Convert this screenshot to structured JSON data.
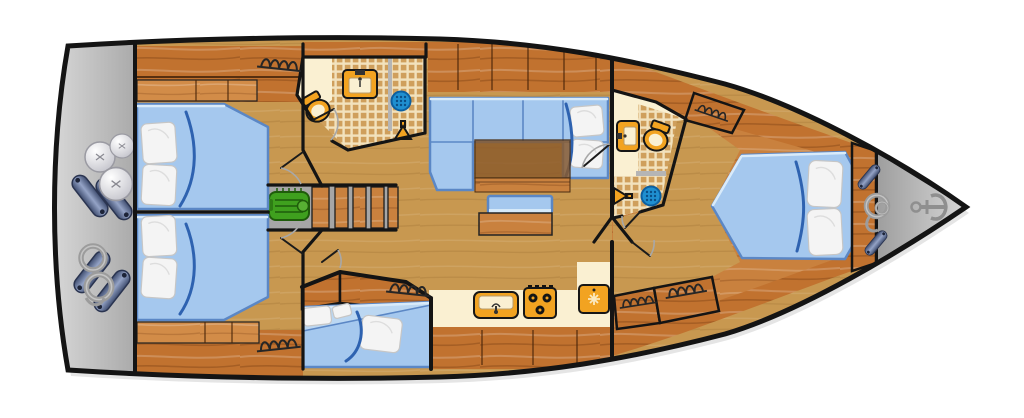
{
  "diagram": {
    "type": "sailing-yacht-interior-floor-plan",
    "description": "Top-down interior layout plan of a sailing yacht, bow pointing right, stern platform on the left"
  },
  "orientation": {
    "bow": "right",
    "stern": "left"
  },
  "colors": {
    "hull_line": "#141414",
    "floor_tan": "#C89850",
    "wood_dark": "#C1722F",
    "wood_mid": "#C9813E",
    "wood_light": "#D28C48",
    "bed_blue": "#A5C8EE",
    "bed_blue_light": "#BBD7F2",
    "bed_edge": "#5B87C5",
    "blanket_blue": "#2E62B0",
    "pillow_white": "#F4F4F4",
    "tile_base": "#F2E2BD",
    "tile_square": "#CF9F5C",
    "counter_cream": "#FAF0D2",
    "fixture_orange": "#F2A321",
    "drain_blue": "#1F8FD0",
    "engine_green": "#3FA01E",
    "platform_gray_light": "#DCDCDC",
    "platform_gray_dark": "#A9A9A9",
    "fender_dark": "#3E4C6E",
    "fender_light": "#94A3C6",
    "rope_gray": "#9C9C9C",
    "table_brown": "#8B5A2B"
  },
  "areas": [
    {
      "id": "stern-platform",
      "features": [
        "round-fenders",
        "cylinder-fenders",
        "mooring-rope-coils"
      ]
    },
    {
      "id": "aft-cabin-port",
      "features": [
        "double-bed",
        "two-pillows",
        "wardrobe-spring",
        "shelving"
      ]
    },
    {
      "id": "aft-cabin-starboard",
      "features": [
        "double-bed",
        "two-pillows",
        "wardrobe-spring",
        "shelving"
      ]
    },
    {
      "id": "engine-compartment",
      "features": [
        "engine"
      ]
    },
    {
      "id": "companionway-stairs",
      "features": [
        "five-steps"
      ]
    },
    {
      "id": "bathroom-port",
      "features": [
        "toilet",
        "sink",
        "shower-drain",
        "shower-head",
        "glass-partition",
        "tiled-floor"
      ]
    },
    {
      "id": "salon",
      "features": [
        "l-shaped-sofa",
        "two-pillows",
        "dining-table",
        "bench-seat",
        "overhead-cabinets"
      ]
    },
    {
      "id": "galley",
      "features": [
        "sink",
        "three-burner-stove",
        "refrigerator",
        "counter",
        "cabinets"
      ]
    },
    {
      "id": "mid-cabin-starboard",
      "features": [
        "double-bed",
        "pillows",
        "wardrobe-spring"
      ]
    },
    {
      "id": "bathroom-forward",
      "features": [
        "toilet",
        "sink",
        "shower-drain",
        "shower-head",
        "glass-partition",
        "tiled-floor"
      ]
    },
    {
      "id": "master-cabin-forward",
      "features": [
        "island-double-bed",
        "two-pillows",
        "wardrobe-springs",
        "bed-platform"
      ]
    },
    {
      "id": "bow-locker",
      "features": [
        "anchor",
        "rope-coil",
        "fenders"
      ]
    }
  ],
  "icons": [
    "anchor-icon",
    "engine-icon",
    "toilet-icon",
    "sink-icon",
    "shower-drain-icon",
    "shower-head-icon",
    "stove-icon",
    "refrigerator-icon",
    "fender-ball-icon",
    "fender-cylinder-icon",
    "rope-coil-icon",
    "wardrobe-spring-icon",
    "door-swing-icon"
  ]
}
